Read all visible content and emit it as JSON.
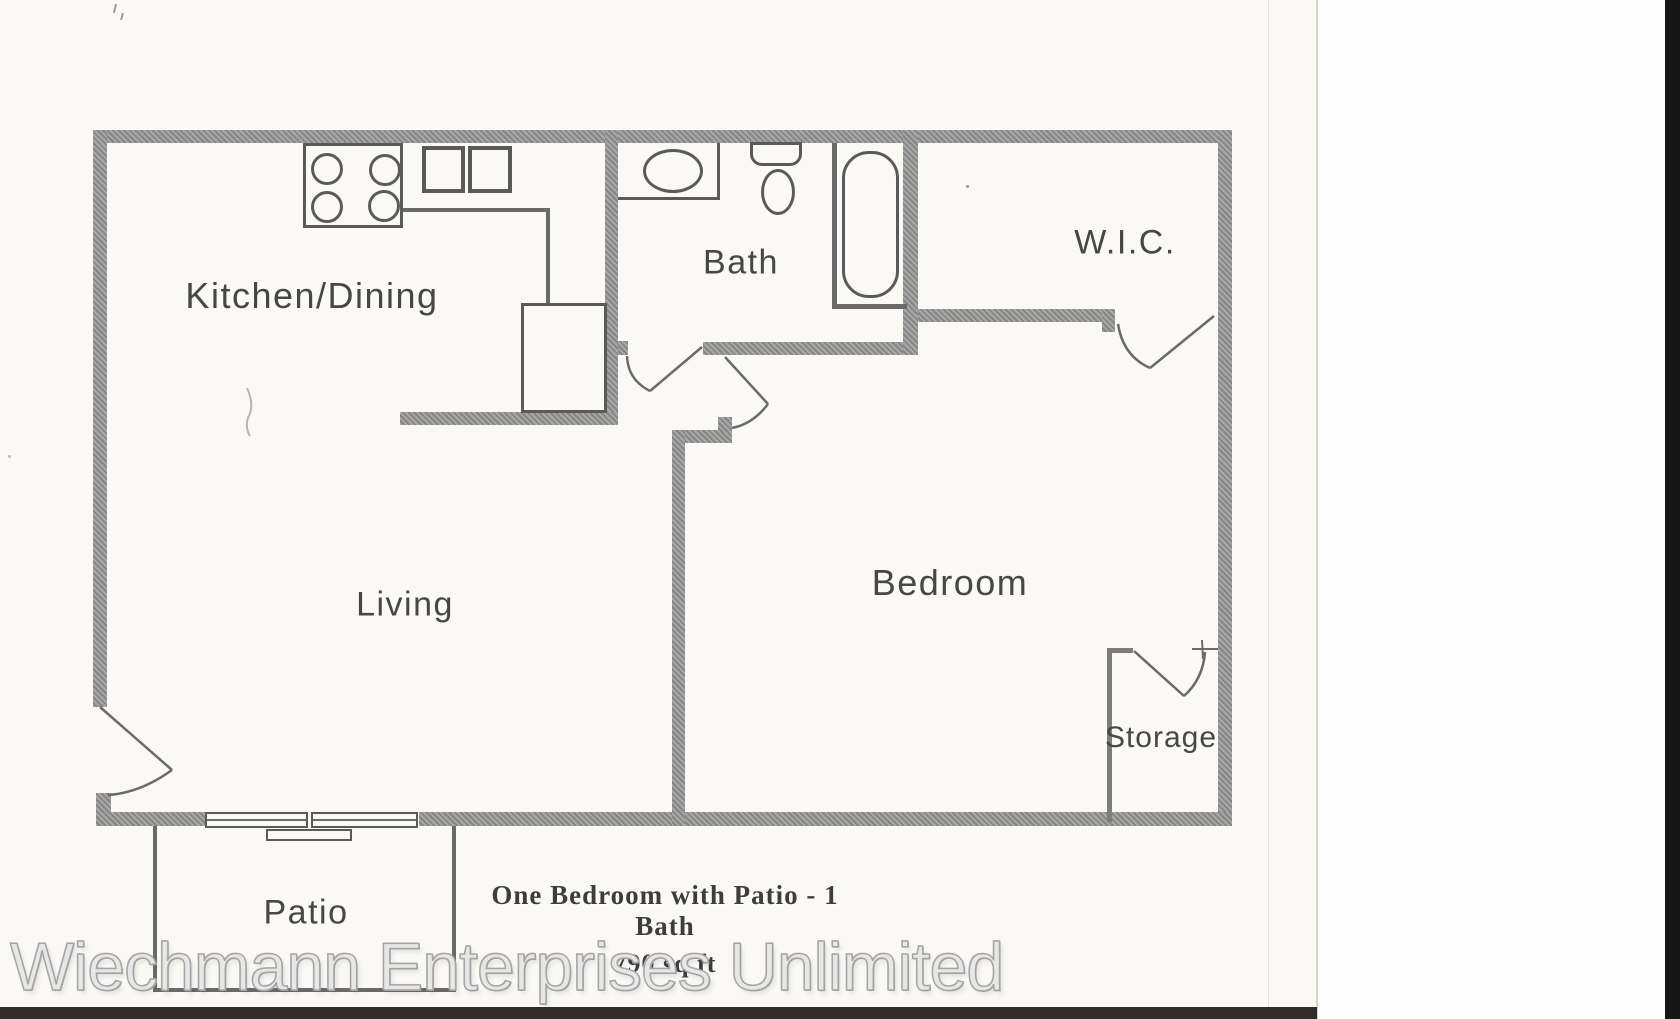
{
  "document": {
    "type": "scanned apartment floor plan",
    "caption": {
      "title": "One Bedroom with Patio - 1 Bath",
      "area": "790 sq ft"
    },
    "watermark": "Wiechmann Enterprises Unlimited",
    "rooms": {
      "kitchen_dining": "Kitchen/Dining",
      "bath": "Bath",
      "wic": "W.I.C.",
      "living": "Living",
      "bedroom": "Bedroom",
      "storage": "Storage",
      "patio": "Patio"
    },
    "colors": {
      "wall_gray": "#8e8e8e",
      "fixture_line": "#5a5a5a",
      "paper": "#faf9f5",
      "scan_edge_black": "#161616",
      "label_text": "#474747"
    }
  }
}
